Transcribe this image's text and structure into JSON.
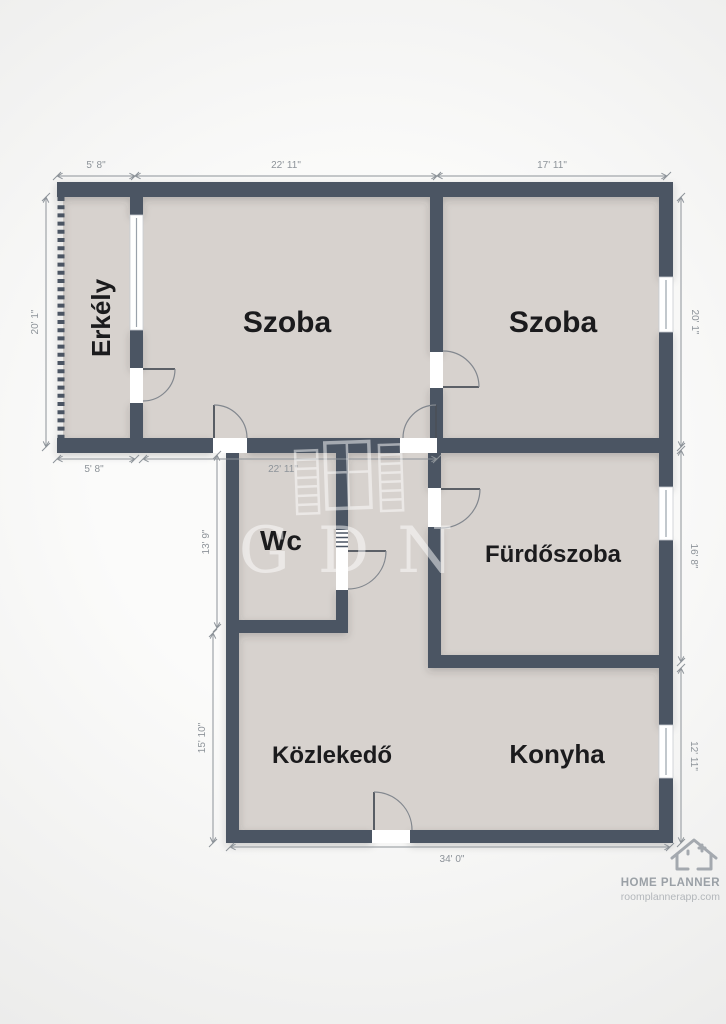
{
  "title": "Floor plan",
  "rooms": {
    "erkely": {
      "label": "Erkély"
    },
    "szoba_left": {
      "label": "Szoba"
    },
    "szoba_right": {
      "label": "Szoba"
    },
    "wc": {
      "label": "Wc"
    },
    "furdoszoba": {
      "label": "Fürdőszoba"
    },
    "kozlekedo": {
      "label": "Közlekedő"
    },
    "konyha": {
      "label": "Konyha"
    }
  },
  "dimensions": {
    "top": [
      "5' 8\"",
      "22' 11\"",
      "17' 11\""
    ],
    "inner": [
      "5' 8\"",
      "22' 11\""
    ],
    "left": [
      "20' 1\"",
      "13' 9\"",
      "15' 10\""
    ],
    "right": [
      "20' 1\"",
      "16' 8\"",
      "12' 11\""
    ],
    "bottom": [
      "34' 0\""
    ]
  },
  "watermark": {
    "text": "GDN"
  },
  "footer": {
    "brand": "HOME PLANNER",
    "url": "roomplannerapp.com"
  },
  "colors": {
    "wall": "#4b5563",
    "floor": "#d7d2ce",
    "background": "#f6f6f5",
    "dimension": "#8d9399",
    "label": "#1b1b1d",
    "watermark": "#ffffff",
    "footer": "#9aa0a6"
  }
}
